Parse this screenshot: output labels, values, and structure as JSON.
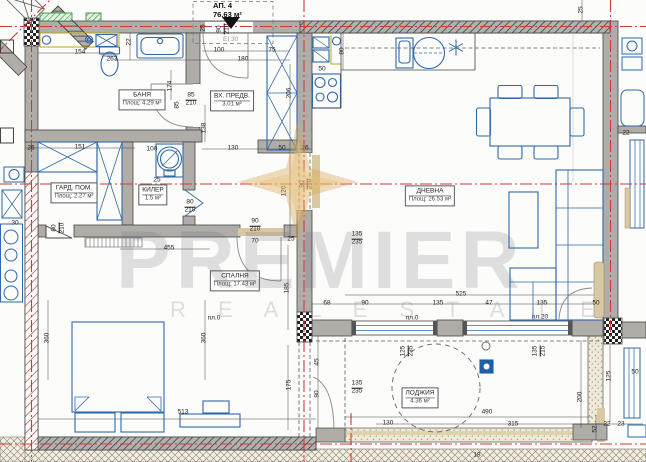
{
  "title": {
    "apartment": "АП. 4",
    "area": "76.63 м²",
    "fire": "EI 30"
  },
  "watermark": {
    "word": "PREMIER",
    "subtitle": "R E A L   E S T A T E",
    "logo": "compass-star-icon",
    "gold": "#d9a855"
  },
  "symbols": {
    "entrance": "triangle-marker-icon",
    "boiler": "water-heater-icon",
    "drain": "floor-drain-icon",
    "hob": "cooktop-star-icon"
  },
  "colors": {
    "wall": "#b0ada9",
    "axis_red": "#cf3a3a",
    "furniture_blue": "#3068a8",
    "counter_yellow": "#b8a715",
    "vent_green": "#2e7d32",
    "sand": "#efe9d8",
    "tan": "#d9c9a3"
  },
  "rooms": [
    {
      "name": "БАНЯ",
      "area": "Площ: 4.29 м²",
      "x": 142,
      "y": 100
    },
    {
      "name": "ВХ. ПРЕДВ.",
      "area": "3.01 м²",
      "x": 232,
      "y": 101
    },
    {
      "name": "ГАРД. ПОМ.",
      "area": "Площ: 2.27 м²",
      "x": 74,
      "y": 193
    },
    {
      "name": "КИЛЕР",
      "area": "1.5 м²",
      "x": 153,
      "y": 195
    },
    {
      "name": "СПАЛНЯ",
      "area": "Площ: 17.43 м²",
      "x": 235,
      "y": 281
    },
    {
      "name": "ДНЕВНА",
      "area": "Площ: 26.53 м²",
      "x": 430,
      "y": 196
    },
    {
      "name": "ЛОДЖИЯ",
      "area": "4.36 м²",
      "x": 420,
      "y": 398
    }
  ],
  "dims": [
    {
      "t": "154",
      "x": 80,
      "y": 53
    },
    {
      "t": "263",
      "x": 112,
      "y": 60
    },
    {
      "t": "22",
      "x": 130,
      "y": 42,
      "r": -90
    },
    {
      "t": "100",
      "x": 219,
      "y": 51
    },
    {
      "t": "75",
      "x": 272,
      "y": 51
    },
    {
      "t": "180",
      "x": 243,
      "y": 60
    },
    {
      "t": "25",
      "x": 204,
      "y": 28,
      "r": -90
    },
    {
      "t": "90",
      "b": "210",
      "x": 224,
      "y": 29,
      "r": -90
    },
    {
      "t": "50",
      "x": 322,
      "y": 70
    },
    {
      "t": "80",
      "x": 343,
      "y": 51,
      "r": -90
    },
    {
      "t": "206",
      "x": 290,
      "y": 93,
      "r": -90
    },
    {
      "t": "138",
      "x": 205,
      "y": 128,
      "r": -90
    },
    {
      "t": "174",
      "x": 171,
      "y": 86,
      "r": -90
    },
    {
      "t": "85",
      "x": 178,
      "y": 105,
      "r": -90
    },
    {
      "t": "85",
      "b": "210",
      "x": 191,
      "y": 100
    },
    {
      "t": "130",
      "x": 233,
      "y": 149
    },
    {
      "t": "50",
      "x": 282,
      "y": 149
    },
    {
      "t": "26",
      "x": 305,
      "y": 149
    },
    {
      "t": "26",
      "x": 31,
      "y": 149
    },
    {
      "t": "151",
      "x": 80,
      "y": 148
    },
    {
      "t": "100",
      "x": 152,
      "y": 150
    },
    {
      "t": "25",
      "x": 157,
      "y": 181
    },
    {
      "t": "30",
      "x": 15,
      "y": 224
    },
    {
      "t": "80",
      "b": "210",
      "x": 59,
      "y": 228,
      "r": -90
    },
    {
      "t": "80",
      "b": "210",
      "x": 190,
      "y": 207
    },
    {
      "t": "455",
      "x": 169,
      "y": 249
    },
    {
      "t": "90",
      "b": "210",
      "x": 255,
      "y": 226
    },
    {
      "t": "70",
      "x": 255,
      "y": 242
    },
    {
      "t": "25",
      "x": 291,
      "y": 240
    },
    {
      "t": "120",
      "x": 285,
      "y": 191,
      "r": -90
    },
    {
      "t": "90",
      "b": "210",
      "x": 307,
      "y": 184,
      "r": -90
    },
    {
      "t": "185",
      "x": 288,
      "y": 288,
      "r": -90
    },
    {
      "t": "175",
      "x": 290,
      "y": 385,
      "r": -90
    },
    {
      "t": "360",
      "x": 48,
      "y": 338,
      "r": -90
    },
    {
      "t": "360",
      "x": 205,
      "y": 338,
      "r": -90
    },
    {
      "t": "513",
      "x": 183,
      "y": 413
    },
    {
      "t": "525",
      "x": 461,
      "y": 295
    },
    {
      "t": "135",
      "x": 438,
      "y": 304
    },
    {
      "t": "47",
      "x": 489,
      "y": 304
    },
    {
      "t": "135",
      "x": 542,
      "y": 304
    },
    {
      "t": "50",
      "x": 596,
      "y": 304
    },
    {
      "t": "68",
      "x": 327,
      "y": 304
    },
    {
      "t": "90",
      "x": 365,
      "y": 304
    },
    {
      "t": "45",
      "x": 318,
      "y": 362,
      "r": -90
    },
    {
      "t": "90",
      "x": 318,
      "y": 394,
      "r": -90
    },
    {
      "t": "135",
      "b": "235",
      "x": 357,
      "y": 239
    },
    {
      "t": "135",
      "b": "235",
      "x": 357,
      "y": 388
    },
    {
      "t": "135",
      "b": "215",
      "x": 540,
      "y": 351,
      "r": -90
    },
    {
      "t": "125",
      "b": "235",
      "x": 408,
      "y": 351,
      "r": -90
    },
    {
      "t": "490",
      "x": 487,
      "y": 413
    },
    {
      "t": "315",
      "x": 513,
      "y": 425
    },
    {
      "t": "130",
      "x": 388,
      "y": 424
    },
    {
      "t": "22",
      "x": 607,
      "y": 425
    },
    {
      "t": "23",
      "x": 621,
      "y": 425
    },
    {
      "t": "200",
      "x": 581,
      "y": 397,
      "r": -90
    },
    {
      "t": "125",
      "x": 610,
      "y": 376,
      "r": -90
    },
    {
      "t": "52",
      "x": 596,
      "y": 429,
      "r": -90
    },
    {
      "t": "пл.0",
      "x": 214,
      "y": 319
    },
    {
      "t": "пл.0",
      "x": 412,
      "y": 319
    },
    {
      "t": "пл.20",
      "x": 540,
      "y": 318
    },
    {
      "t": "18",
      "x": 477,
      "y": 456
    },
    {
      "t": "25",
      "x": 582,
      "y": 10,
      "r": -90
    },
    {
      "t": "22",
      "x": 626,
      "y": 134
    },
    {
      "t": "50",
      "x": 635,
      "y": 373
    }
  ]
}
